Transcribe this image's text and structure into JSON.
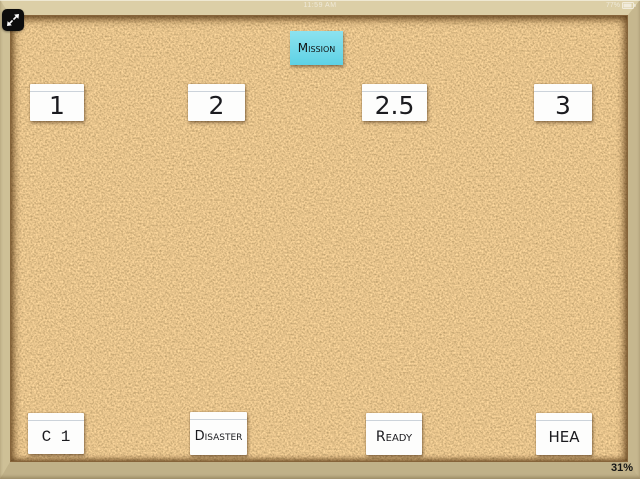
{
  "status_bar": {
    "time": "11:59 AM",
    "battery_percent": "77%"
  },
  "toolbar": {
    "expand_icon": "expand-diagonal-arrows"
  },
  "board": {
    "sticky_note": {
      "label": "Mission"
    },
    "top_cards": [
      {
        "label": "1"
      },
      {
        "label": "2"
      },
      {
        "label": "2.5"
      },
      {
        "label": "3"
      }
    ],
    "bottom_cards": [
      {
        "label": "C 1"
      },
      {
        "label": "Disaster"
      },
      {
        "label": "Ready"
      },
      {
        "label": "HEA"
      }
    ]
  },
  "hud": {
    "zoom_level": "31%"
  },
  "colors": {
    "cork_base": "#c7873e",
    "frame_wood": "#cfc198",
    "card": "#fdfdfc",
    "sticky_note": "#6fd8e8"
  }
}
